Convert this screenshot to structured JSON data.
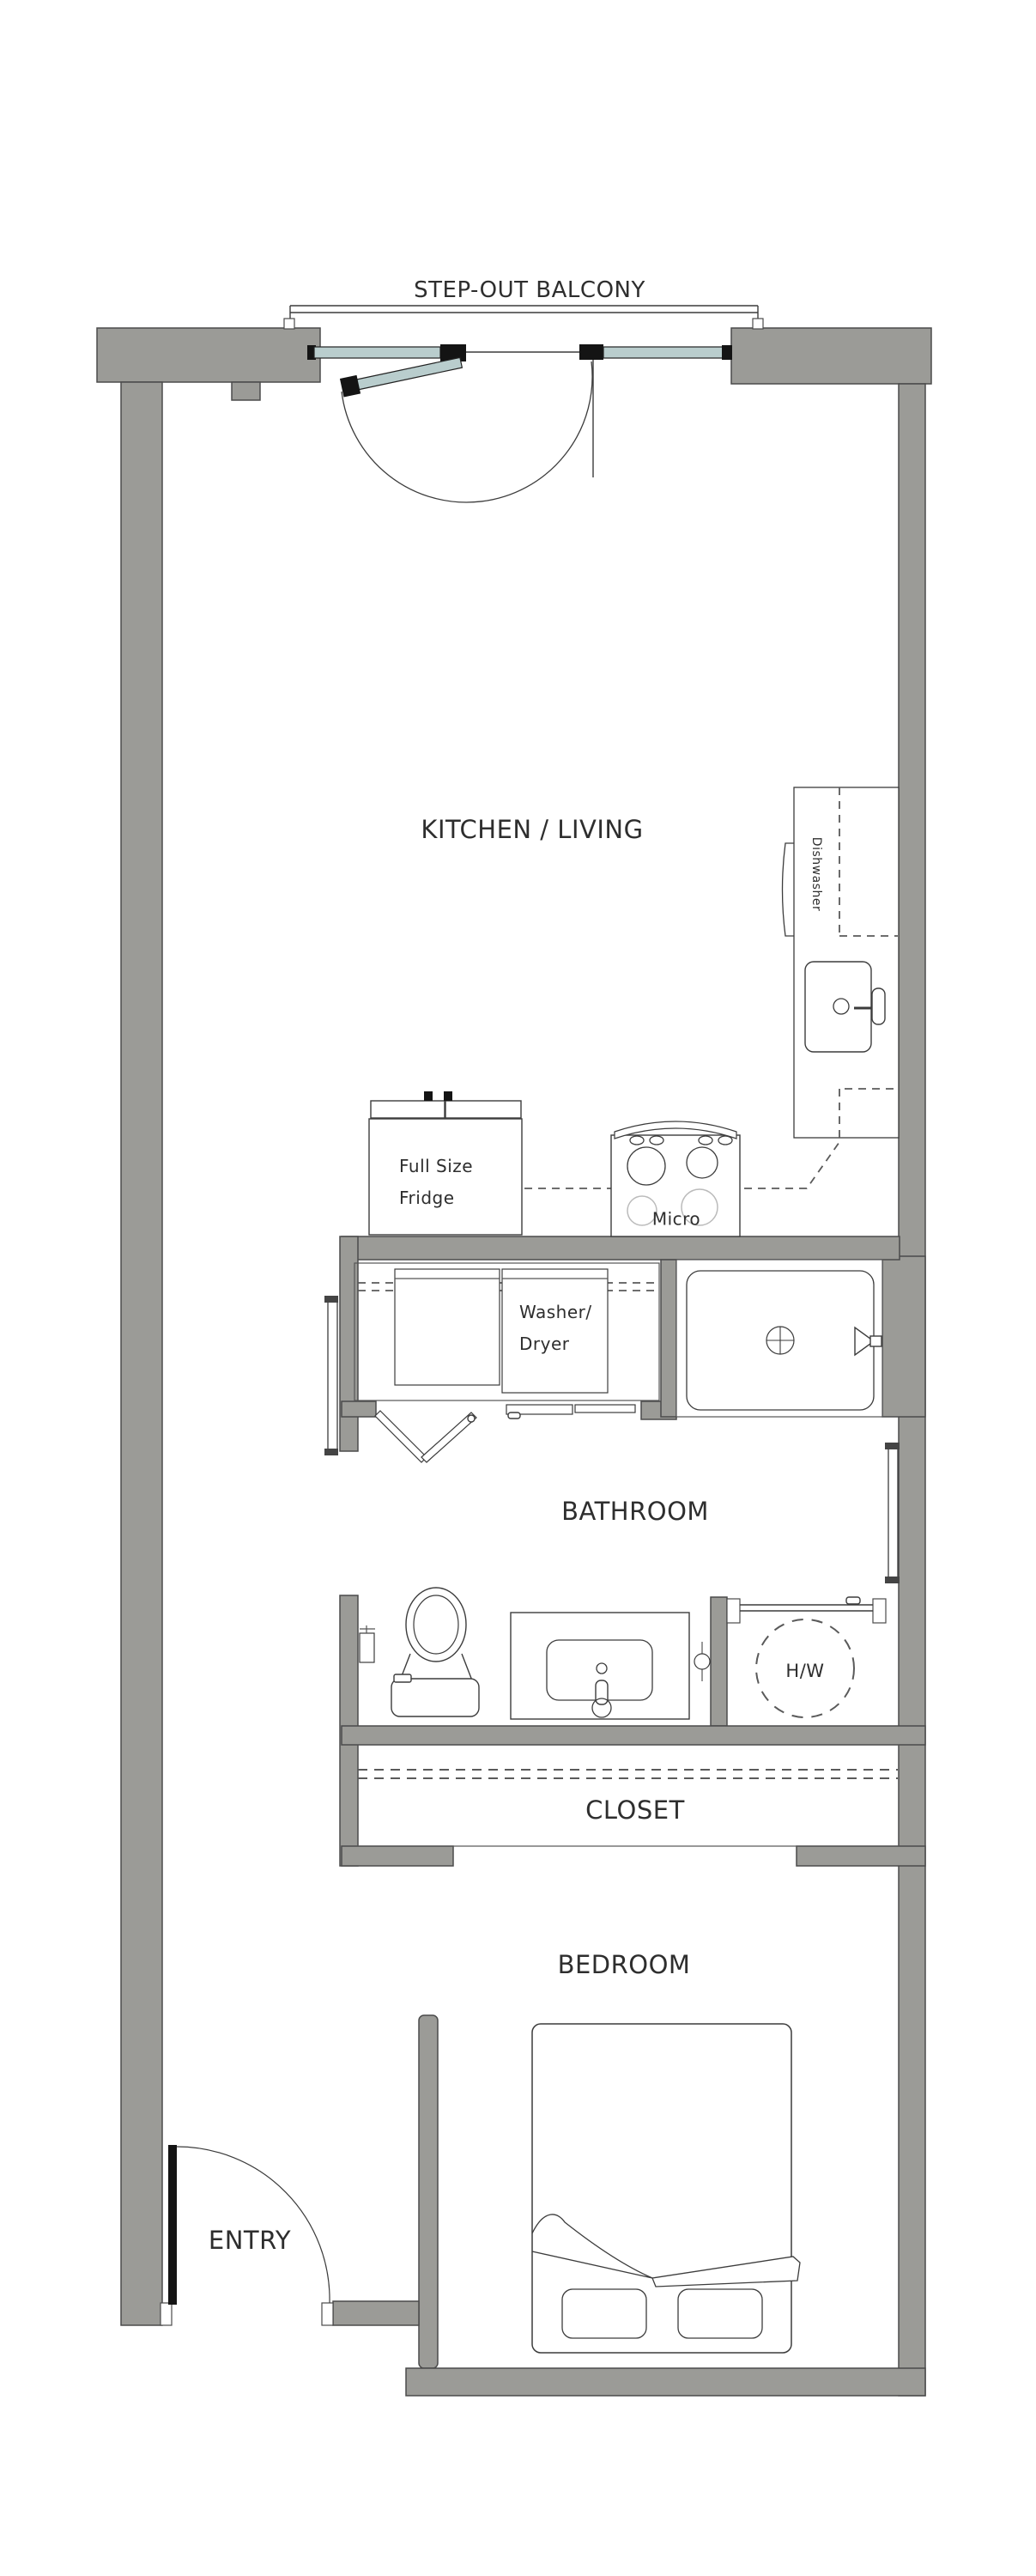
{
  "rooms": {
    "balcony": "STEP-OUT BALCONY",
    "kitchen_living": "KITCHEN / LIVING",
    "bathroom": "BATHROOM",
    "closet": "CLOSET",
    "bedroom": "BEDROOM",
    "entry": "ENTRY"
  },
  "appliances": {
    "dishwasher": "Dishwasher",
    "fridge_line1": "Full Size",
    "fridge_line2": "Fridge",
    "micro": "Micro",
    "washer_line1": "Washer/",
    "washer_line2": "Dryer",
    "hot_water": "H/W"
  },
  "colors": {
    "wall": "#9b9b97",
    "wall_outline": "#4b4b4b",
    "line": "#3c3c3c",
    "glass": "#b9cdcd",
    "black": "#141414",
    "text": "#2e2e2e",
    "dash": "#5a5a5a",
    "light": "#bbbbbb"
  }
}
